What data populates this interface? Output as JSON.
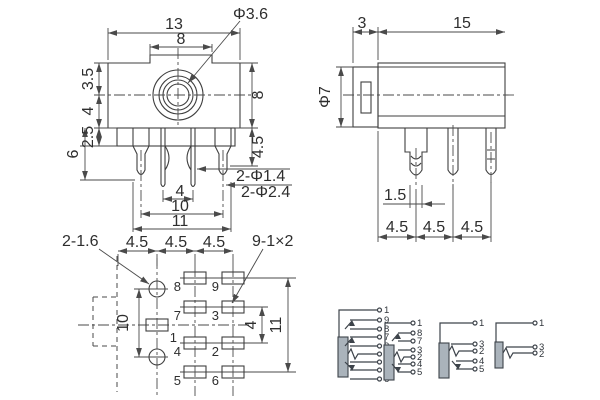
{
  "drawing": {
    "front_view": {
      "overall_width": "13",
      "boss_width": "8",
      "jack_hole_dia": "Φ3.6",
      "dim_top_to_center": "3.5",
      "dim_center_to_bottom": "4",
      "dim_flange": "2.5",
      "dim_pin_total": "6",
      "body_height": "8",
      "pin_length": "4.5",
      "note_small_pins": "2-Φ1.4",
      "note_large_pins": "2-Φ2.4",
      "center_pin_pitch": "4",
      "outer_pin_pitch": "10",
      "overall_pin_span": "11"
    },
    "side_view": {
      "front_depth": "3",
      "body_length": "15",
      "barrel_dia": "Φ7",
      "pin_thickness": "1.5",
      "pitch": [
        "4.5",
        "4.5",
        "4.5"
      ]
    },
    "pcb_view": {
      "note_holes": "2-1.6",
      "pitch": [
        "4.5",
        "4.5",
        "4.5"
      ],
      "note_pads": "9-1×2",
      "hole_span": "10",
      "row_pitch": "4",
      "row_span": "11",
      "pads": [
        "1",
        "2",
        "3",
        "4",
        "5",
        "6",
        "7",
        "8",
        "9"
      ]
    },
    "schematics": [
      {
        "terminals": [
          "1",
          "9",
          "8",
          "7",
          "3",
          "2",
          "4",
          "5",
          "6"
        ]
      },
      {
        "terminals": [
          "1",
          "8",
          "7",
          "3",
          "2",
          "4",
          "5"
        ]
      },
      {
        "terminals": [
          "1",
          "3",
          "2",
          "4",
          "5"
        ]
      },
      {
        "terminals": [
          "1",
          "3",
          "2"
        ]
      }
    ]
  }
}
